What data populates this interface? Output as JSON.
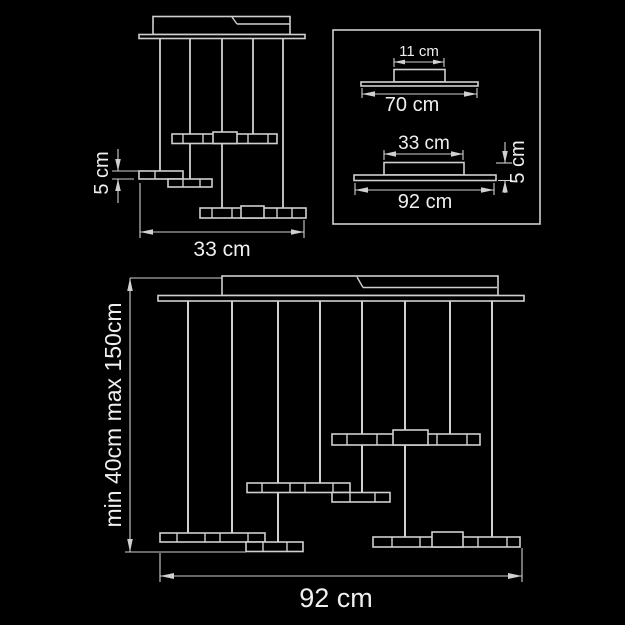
{
  "colors": {
    "background": "#000000",
    "line": "#d0d0d0",
    "text": "#efefef"
  },
  "plan_view": {
    "height_label": "5 cm",
    "width_label": "33 cm"
  },
  "profile_box": {
    "canopy_width_label": "11 cm",
    "canopy_base_label": "70 cm",
    "bar_width_label": "33 cm",
    "bar_base_label": "92 cm",
    "bar_height_label": "5 cm"
  },
  "front_view": {
    "height_label": "min 40cm  max 150cm",
    "width_label": "92 cm"
  }
}
